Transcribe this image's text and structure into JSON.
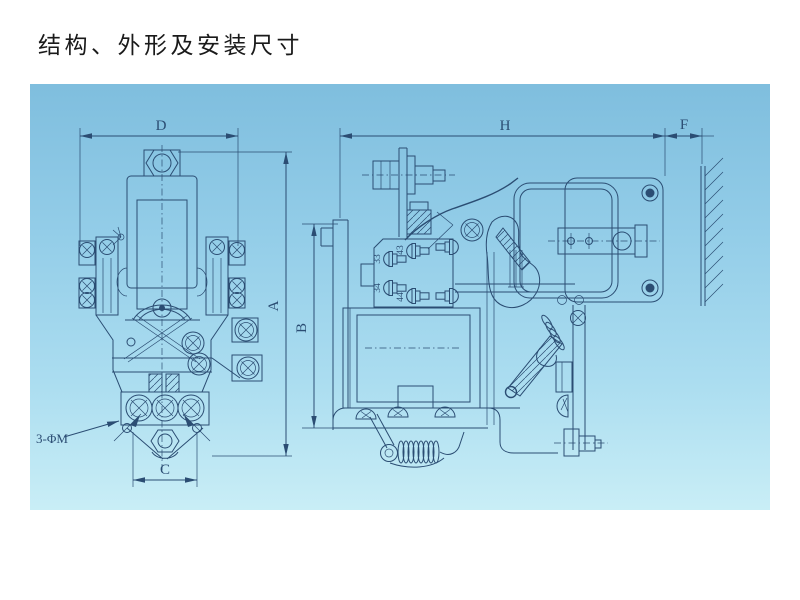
{
  "title": "结构、外形及安装尺寸",
  "dims": {
    "d": "D",
    "a": "A",
    "b": "B",
    "c": "C",
    "h": "H",
    "f": "F"
  },
  "left_view": {
    "hole_note": "3-ΦM"
  },
  "right_view": {
    "terminals": [
      "43",
      "33",
      "34",
      "44"
    ]
  },
  "colors": {
    "paper": "#ffffff",
    "line": "#2b4d73",
    "title": "#1a1a1a",
    "bp1": "#7fbede",
    "bp2": "#93cde8",
    "bp3": "#abddf0",
    "bp4": "#c9eef6"
  }
}
